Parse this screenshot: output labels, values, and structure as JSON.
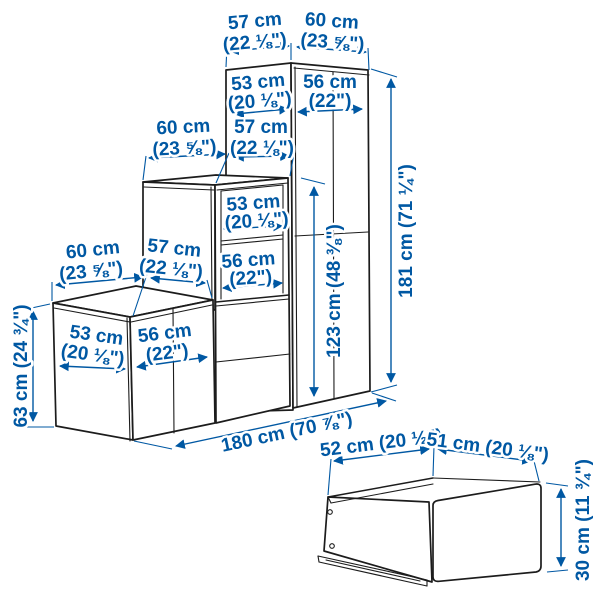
{
  "title": "Storage combination with drawer — dimension diagram",
  "colors": {
    "dimension_blue": "#0058a3",
    "outline_dark": "#1c1c1c",
    "background": "#ffffff"
  },
  "main_unit": {
    "tall_cabinet": {
      "top_width": {
        "cm": "57 cm",
        "inch": "(22 ⅛\")"
      },
      "top_depth": {
        "cm": "60 cm",
        "inch": "(23 ⅝\")"
      },
      "side_panel": {
        "cm": "53 cm",
        "inch": "(20 ⅛\")"
      },
      "front": {
        "cm": "56 cm",
        "inch": "(22\")"
      },
      "height": "181 cm (71 ¼\")"
    },
    "middle_cabinet": {
      "top_width": {
        "cm": "60 cm",
        "inch": "(23 ⅝\")"
      },
      "top_depth": {
        "cm": "57 cm",
        "inch": "(22 ⅛\")"
      },
      "shelf_upper": {
        "cm": "53 cm",
        "inch": "(20 ⅛\")"
      },
      "shelf_lower": {
        "cm": "56 cm",
        "inch": "(22\")"
      },
      "height": "123 cm (48 ⅜\")"
    },
    "low_cabinet": {
      "top_width": {
        "cm": "60 cm",
        "inch": "(23 ⅝\")"
      },
      "top_depth": {
        "cm": "57 cm",
        "inch": "(22 ⅛\")"
      },
      "side_panel": {
        "cm": "53 cm",
        "inch": "(20 ⅛\")"
      },
      "front": {
        "cm": "56 cm",
        "inch": "(22\")"
      },
      "height": "63 cm (24 ¾\")"
    },
    "total_width": "180 cm (70 ⅞\")"
  },
  "drawer": {
    "width": "52 cm (20 ½\")",
    "depth": "51 cm (20 ⅛\")",
    "height": "30 cm (11 ¾\")"
  }
}
